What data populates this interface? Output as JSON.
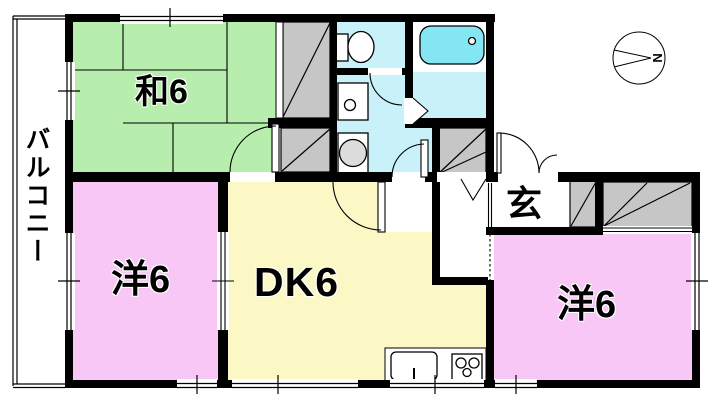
{
  "rooms": {
    "japanese_room": {
      "label": "和6"
    },
    "dining_kitchen": {
      "label": "DK6"
    },
    "western_room_left": {
      "label": "洋6"
    },
    "western_room_right": {
      "label": "洋6"
    },
    "entrance": {
      "label": "玄"
    },
    "balcony": {
      "label": "バルコニー"
    }
  },
  "compass": {
    "north_label": "N"
  },
  "colors": {
    "tatami_green": "#b7eeae",
    "western_room_pink": "#f9c7f5",
    "dk_yellow": "#fcf8c6",
    "wet_area_cyan": "#c9f1fa",
    "bathtub_cyan": "#84e5f3",
    "closet_gray": "#c6c6c6",
    "appliance_gray": "#dcdcdc",
    "wall_black": "#000000"
  }
}
